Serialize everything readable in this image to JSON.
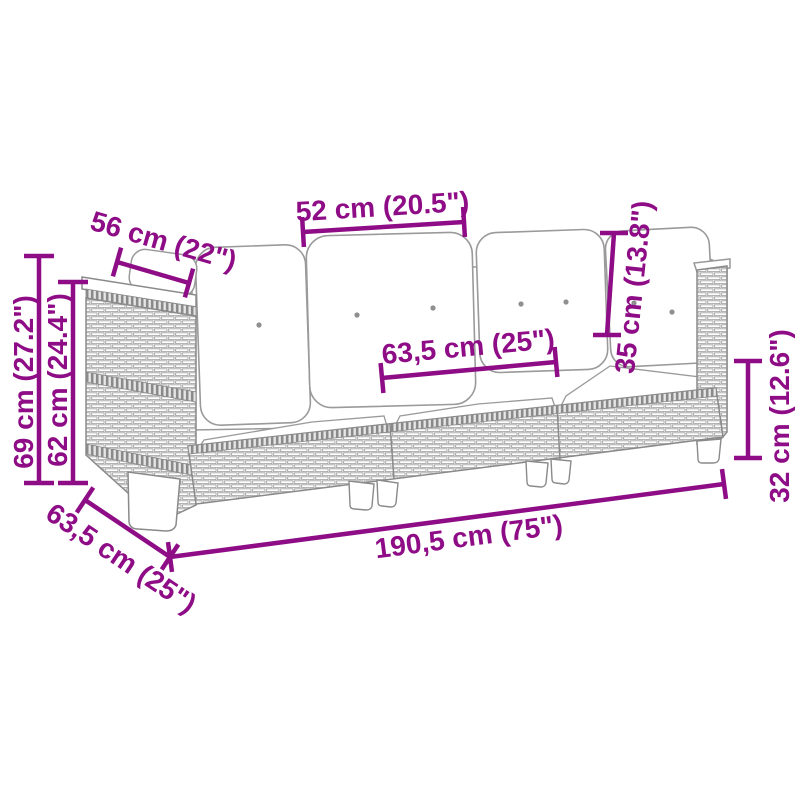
{
  "figure": {
    "kind": "product-dimension-line-art",
    "subject": "3-seater rattan garden sofa with cushions",
    "colors": {
      "background": "#ffffff",
      "accent": "#8E0D86",
      "line_art": "#8a8a8a",
      "weave_stroke": "#a0a0a0",
      "trim_fill": "#8a8a8a",
      "cushion_button": "#8f8f8f"
    },
    "dimensions": {
      "back_cushion_width": {
        "label": "52 cm (20.5\")"
      },
      "armrest_depth": {
        "label": "56 cm (22\")"
      },
      "back_cushion_height": {
        "label": "35 cm (13.8\")"
      },
      "total_height": {
        "label": "69 cm (27.2\")"
      },
      "armrest_height": {
        "label": "62 cm (24.4\")"
      },
      "seat_module_width": {
        "label": "63,5 cm (25\")"
      },
      "seat_height": {
        "label": "32 cm (12.6\")"
      },
      "total_length": {
        "label": "190,5 cm (75\")"
      },
      "total_depth": {
        "label": "63,5 cm (25\")"
      }
    }
  }
}
